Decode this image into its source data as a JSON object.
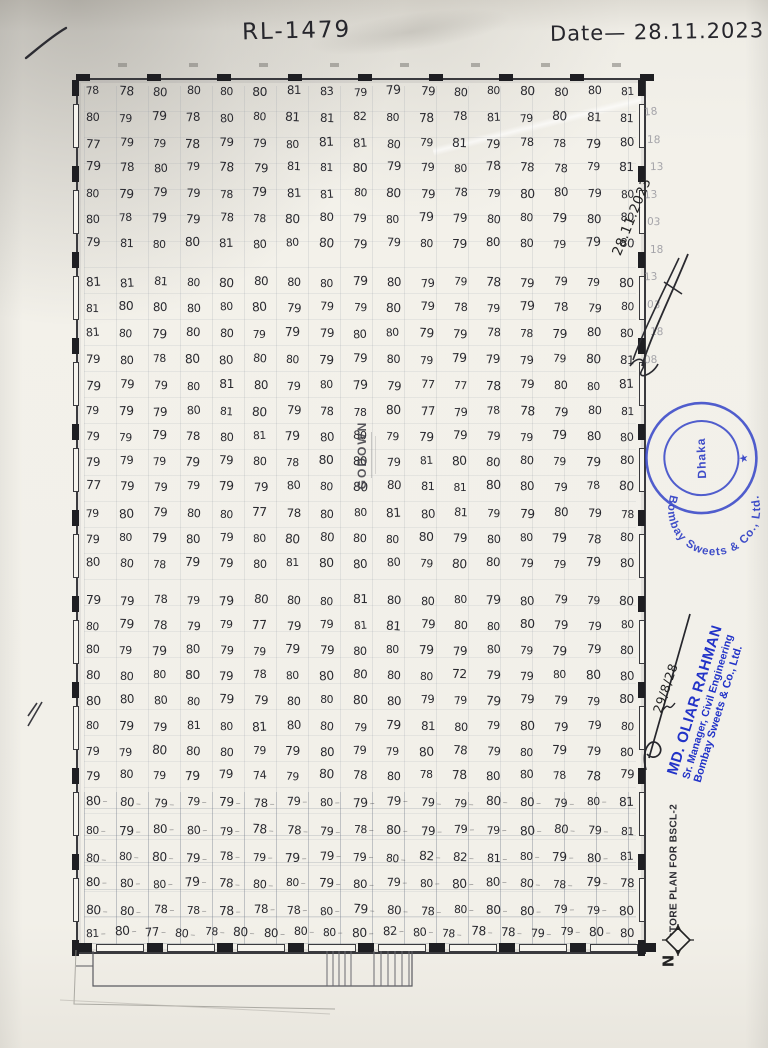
{
  "page": {
    "ref_number": "RL-1479",
    "date": "Date— 28.11.2023",
    "side_date": "28.11.2023",
    "signature_date": "29/8/28"
  },
  "stamp": {
    "ring_text": "Bombay Sweets & Co., Ltd.",
    "center_text": "Dhaka",
    "star": "★",
    "color": "#2f3fc6"
  },
  "credit": {
    "name": "MD. OLIAR RAHMAN",
    "title": "Sr. Manager, Civil Engineering",
    "company": "Bombay Sweets & Co., Ltd.",
    "color": "#2233c8"
  },
  "plan": {
    "room_label": "GODOWN",
    "caption": "STORE PLAN FOR BSCL-2",
    "north_label": "N"
  },
  "grid": {
    "rows": [
      [
        78,
        78,
        80,
        80,
        80,
        80,
        81,
        83,
        79,
        79,
        79,
        80,
        80,
        80,
        80,
        80,
        81
      ],
      [
        80,
        79,
        79,
        78,
        80,
        80,
        81,
        81,
        82,
        80,
        78,
        78,
        81,
        79,
        80,
        81,
        81
      ],
      [
        77,
        79,
        79,
        78,
        79,
        79,
        80,
        81,
        81,
        80,
        79,
        81,
        79,
        78,
        78,
        79,
        80
      ],
      [
        79,
        78,
        80,
        79,
        78,
        79,
        81,
        81,
        80,
        79,
        79,
        80,
        78,
        78,
        78,
        79,
        81
      ],
      [
        80,
        79,
        79,
        79,
        78,
        79,
        81,
        81,
        80,
        80,
        79,
        78,
        79,
        80,
        80,
        79,
        80
      ],
      [
        80,
        78,
        79,
        79,
        78,
        78,
        80,
        80,
        79,
        80,
        79,
        79,
        80,
        80,
        79,
        80,
        80
      ],
      [
        79,
        81,
        80,
        80,
        81,
        80,
        80,
        80,
        79,
        79,
        80,
        79,
        80,
        80,
        79,
        79,
        80
      ],
      [
        81,
        81,
        81,
        80,
        80,
        80,
        80,
        80,
        79,
        80,
        79,
        79,
        78,
        79,
        79,
        79,
        80
      ],
      [
        81,
        80,
        80,
        80,
        80,
        80,
        79,
        79,
        79,
        80,
        79,
        78,
        79,
        79,
        78,
        79,
        80
      ],
      [
        81,
        80,
        79,
        80,
        80,
        79,
        79,
        79,
        80,
        80,
        79,
        79,
        78,
        78,
        79,
        80,
        80
      ],
      [
        79,
        80,
        78,
        80,
        80,
        80,
        80,
        79,
        79,
        80,
        79,
        79,
        79,
        79,
        79,
        80,
        81
      ],
      [
        79,
        79,
        79,
        80,
        81,
        80,
        79,
        80,
        79,
        79,
        77,
        77,
        78,
        79,
        80,
        80,
        81
      ],
      [
        79,
        79,
        79,
        80,
        81,
        80,
        79,
        78,
        78,
        80,
        77,
        79,
        78,
        78,
        79,
        80,
        81
      ],
      [
        79,
        79,
        79,
        78,
        80,
        81,
        79,
        80,
        80,
        79,
        79,
        79,
        79,
        79,
        79,
        80,
        80
      ],
      [
        79,
        79,
        79,
        79,
        79,
        80,
        78,
        80,
        80,
        79,
        81,
        80,
        80,
        80,
        79,
        79,
        80
      ],
      [
        77,
        79,
        79,
        79,
        79,
        79,
        80,
        80,
        80,
        80,
        81,
        81,
        80,
        80,
        79,
        78,
        80
      ],
      [
        79,
        80,
        79,
        80,
        80,
        77,
        78,
        80,
        80,
        81,
        80,
        81,
        79,
        79,
        80,
        79,
        78
      ],
      [
        79,
        80,
        79,
        80,
        79,
        80,
        80,
        80,
        80,
        80,
        80,
        79,
        80,
        80,
        79,
        78,
        80
      ],
      [
        80,
        80,
        78,
        79,
        79,
        80,
        81,
        80,
        80,
        80,
        79,
        80,
        80,
        79,
        79,
        79,
        80
      ],
      [
        79,
        79,
        78,
        79,
        79,
        80,
        80,
        80,
        81,
        80,
        80,
        80,
        79,
        80,
        79,
        79,
        80
      ],
      [
        80,
        79,
        78,
        79,
        79,
        77,
        79,
        79,
        81,
        81,
        79,
        80,
        80,
        80,
        79,
        79,
        80
      ],
      [
        80,
        79,
        79,
        80,
        79,
        79,
        79,
        79,
        80,
        80,
        79,
        79,
        80,
        79,
        79,
        79,
        80
      ],
      [
        80,
        80,
        80,
        80,
        79,
        78,
        80,
        80,
        80,
        80,
        80,
        72,
        79,
        79,
        80,
        80,
        80
      ],
      [
        80,
        80,
        80,
        80,
        79,
        79,
        80,
        80,
        80,
        80,
        79,
        79,
        79,
        79,
        79,
        79,
        80
      ],
      [
        80,
        79,
        79,
        81,
        80,
        81,
        80,
        80,
        79,
        79,
        81,
        80,
        79,
        80,
        79,
        79,
        80
      ],
      [
        79,
        79,
        80,
        80,
        80,
        79,
        79,
        80,
        79,
        79,
        80,
        78,
        79,
        80,
        79,
        79,
        80
      ],
      [
        79,
        80,
        79,
        79,
        79,
        74,
        79,
        80,
        78,
        80,
        78,
        78,
        80,
        80,
        78,
        78,
        79
      ],
      [
        80,
        80,
        79,
        79,
        79,
        78,
        79,
        80,
        79,
        79,
        79,
        79,
        80,
        80,
        79,
        80,
        81
      ],
      [
        80,
        79,
        80,
        80,
        79,
        78,
        78,
        79,
        78,
        80,
        79,
        79,
        79,
        80,
        80,
        79,
        81
      ],
      [
        80,
        80,
        80,
        79,
        78,
        79,
        79,
        79,
        79,
        80,
        82,
        82,
        81,
        80,
        79,
        80,
        81
      ],
      [
        80,
        80,
        80,
        79,
        78,
        80,
        80,
        79,
        80,
        79,
        80,
        80,
        80,
        80,
        78,
        79,
        78
      ],
      [
        80,
        80,
        78,
        78,
        78,
        78,
        78,
        80,
        79,
        80,
        78,
        80,
        80,
        80,
        79,
        79,
        80
      ],
      [
        81,
        80,
        77,
        80,
        78,
        80,
        80,
        80,
        80,
        80,
        82,
        80,
        78,
        78,
        78,
        79,
        79,
        80,
        80
      ]
    ]
  },
  "margin_ghost_numbers": [
    "18",
    "18",
    "13",
    "13",
    "03",
    "18",
    "13",
    "03",
    "18",
    "08"
  ]
}
